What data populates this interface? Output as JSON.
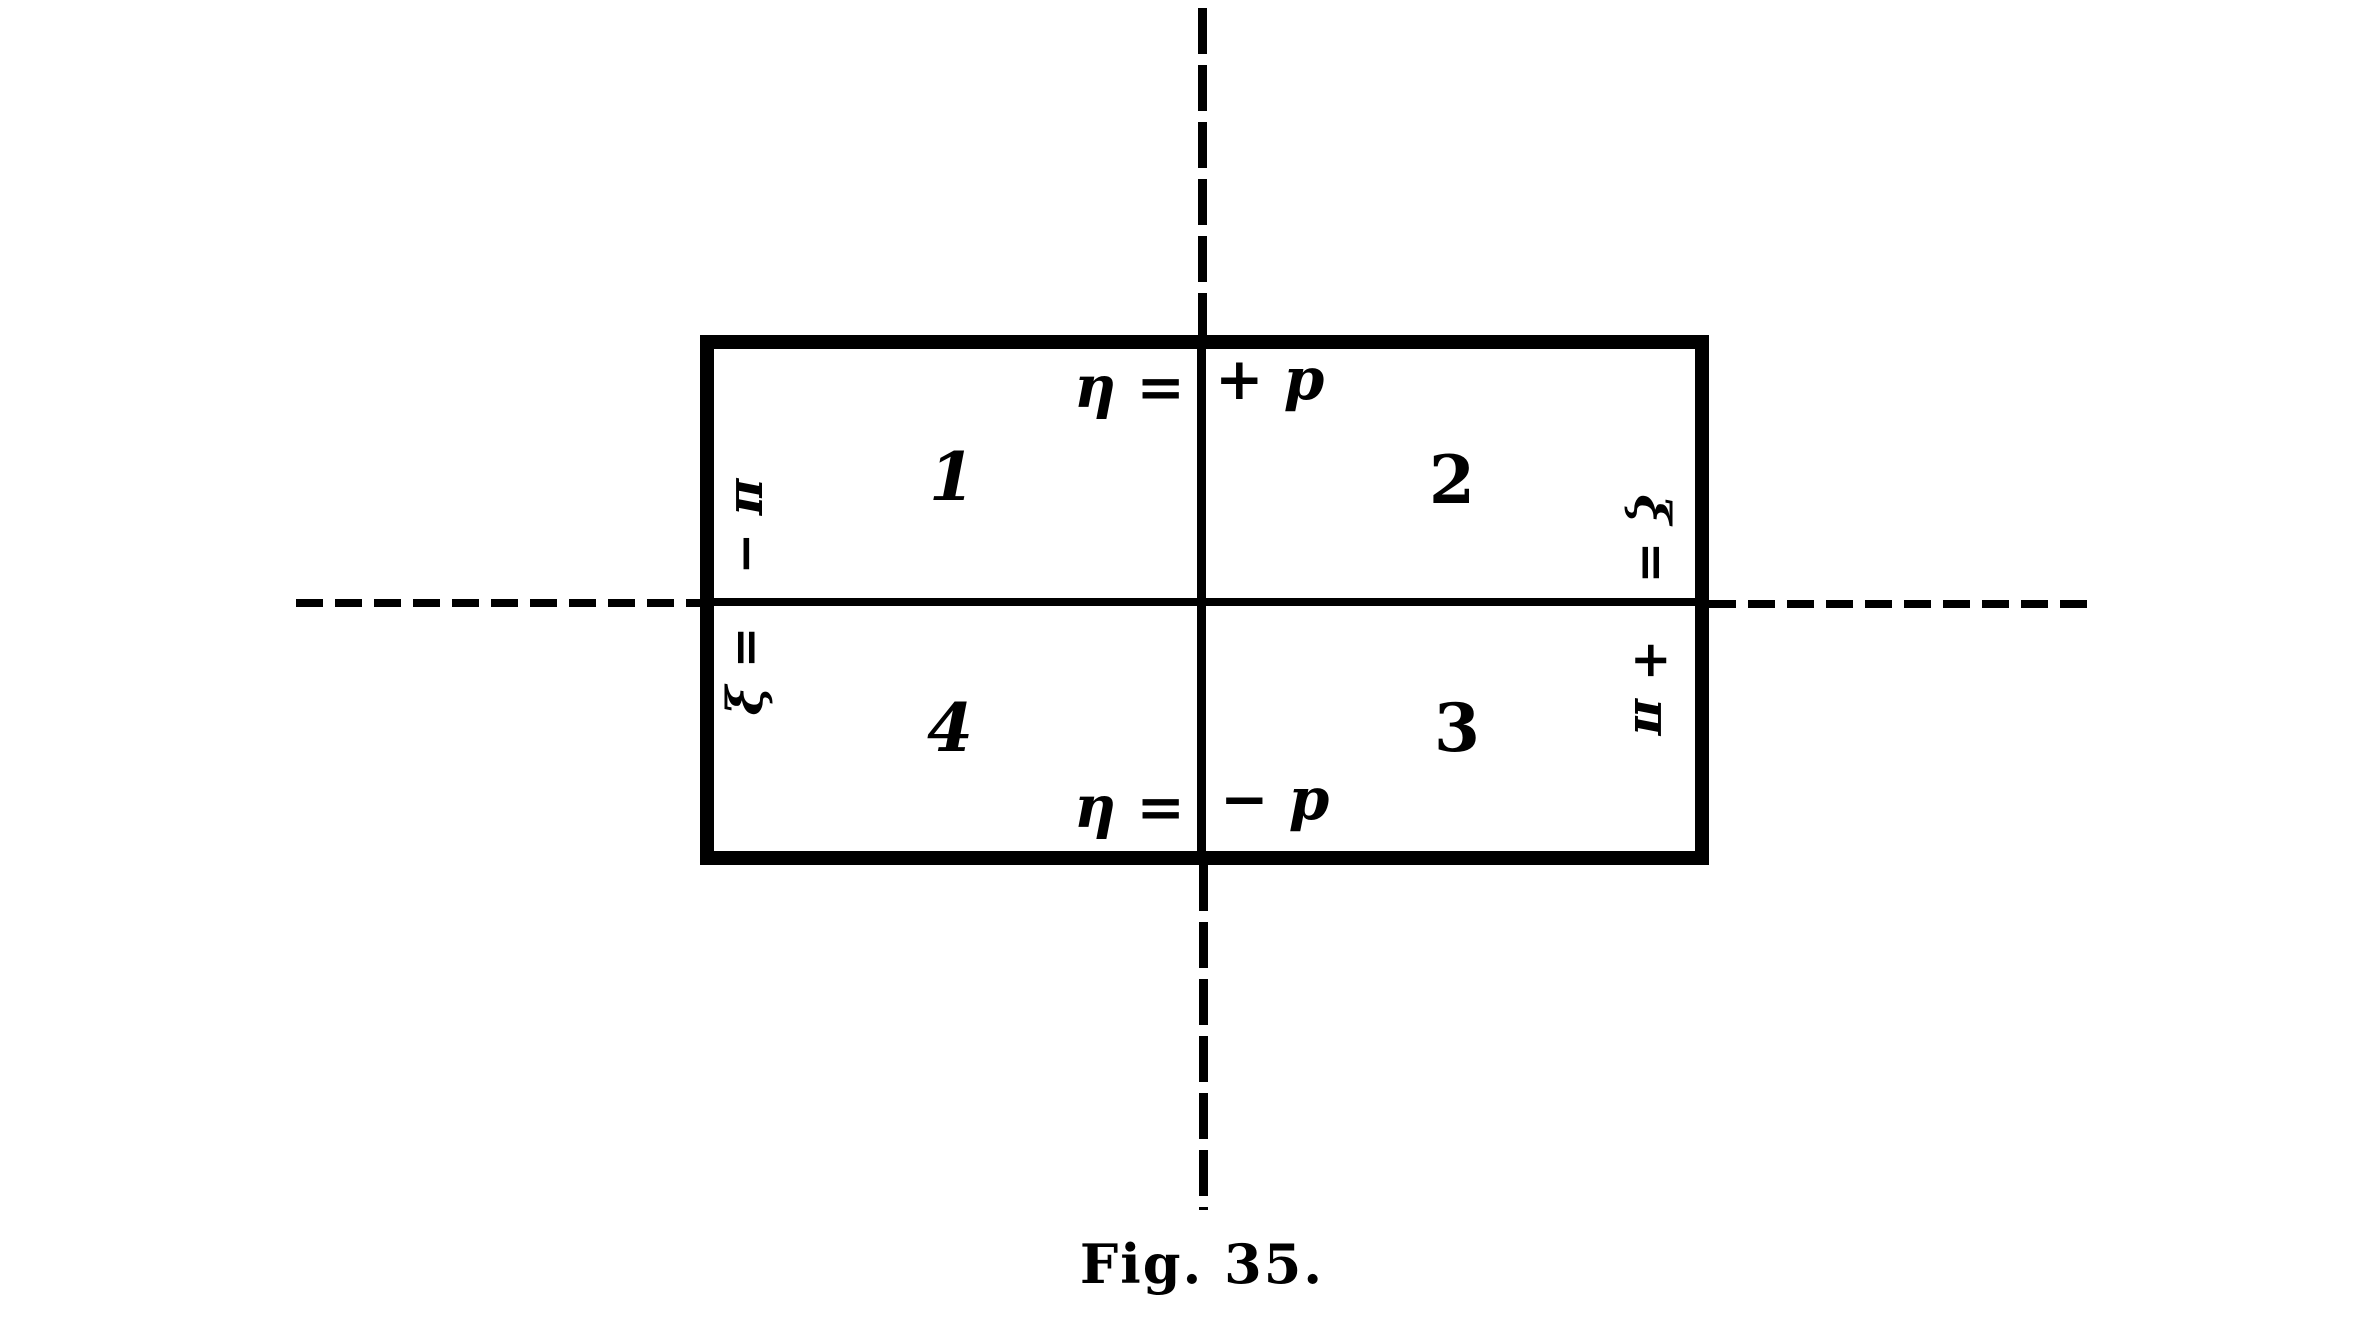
{
  "figure": {
    "type": "quadrant-rectangle-diagram",
    "caption": "Fig. 35.",
    "colors": {
      "ink": "#000000",
      "background": "#ffffff"
    },
    "edge_labels": {
      "top": {
        "lhs": "η =",
        "rhs": "+ p"
      },
      "bottom": {
        "lhs": "η =",
        "rhs": "− p"
      },
      "left": {
        "lhs": "ξ =",
        "rhs": "− π"
      },
      "right": {
        "lhs": "ξ =",
        "rhs": "+ π"
      }
    },
    "quadrants": {
      "top_left": "1",
      "top_right": "2",
      "bottom_right": "3",
      "bottom_left": "4"
    }
  }
}
